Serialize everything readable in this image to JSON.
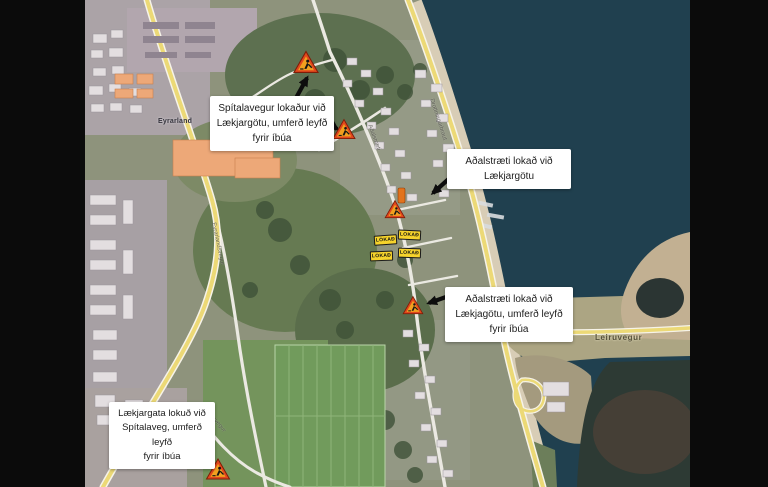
{
  "window": {
    "background": "#0b0b0b"
  },
  "map": {
    "type": "annotated-satellite-roadclosure-map",
    "region_labels": {
      "eyrarland": "Eyrarland"
    },
    "road_labels": {
      "leiruvegur": "Leiruvegur",
      "eyrarlandsvegur": "Eyrarlandsvegur",
      "spitalavegur": "Spítalavegur",
      "adalstraeti": "Aðalstræti",
      "drottningarbraut": "Drottningarbraut"
    },
    "closure_badge_label": "LOKAÐ",
    "closure_badge_count": 4,
    "roadworks_sign_count": 5,
    "callouts": [
      {
        "line1": "Spítalavegur lokaður við",
        "line2": "Lækjargötu, umferð leyfð",
        "line3": "fyrir íbúa"
      },
      {
        "line1": "Aðalstræti lokað við",
        "line2": "Lækjargötu"
      },
      {
        "line1": "Aðalstræti lokað við",
        "line2": "Lækjagötu, umferð leyfð",
        "line3": "fyrir íbúa"
      },
      {
        "line1": "Lækjargata lokuð við",
        "line2": "Spítalaveg, umferð leyfð",
        "line3": "fyrir íbúa"
      }
    ],
    "colors": {
      "water": "#20404f",
      "land": "#8e937c",
      "road_major": "#ecd976",
      "road_minor": "#ebe9e2",
      "beach": "#d8cdb6",
      "closure_badge": "#f6d32c",
      "warning_sign_red": "#e2471d",
      "warning_sign_amber": "#f2a01f"
    }
  }
}
